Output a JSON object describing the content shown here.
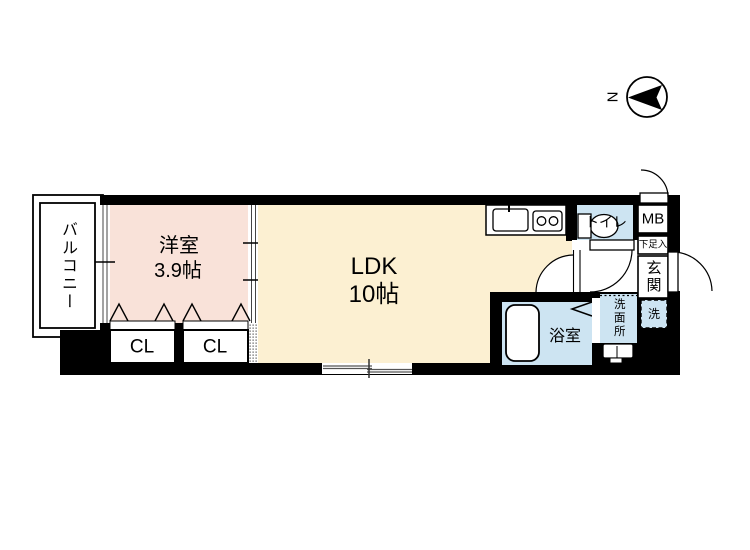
{
  "compass": {
    "north_label": "N"
  },
  "colors": {
    "wall_black": "#000000",
    "western_room_fill": "#f9e2d9",
    "ldk_fill": "#fcf0d2",
    "wet_area_fill": "#cde4f2",
    "floor_white": "#ffffff",
    "window_line_gray": "#555555"
  },
  "rooms": {
    "balcony": {
      "label": "バルコニー"
    },
    "western_room": {
      "label": "洋室",
      "size": "3.9帖"
    },
    "ldk": {
      "label": "LDK",
      "size": "10帖"
    },
    "closet_left": {
      "label": "CL"
    },
    "closet_right": {
      "label": "CL"
    },
    "toilet": {
      "label": "トイレ"
    },
    "meter_box": {
      "label": "MB"
    },
    "shoe_cabinet": {
      "label": "下足入"
    },
    "entrance": {
      "label": "玄関"
    },
    "bathroom": {
      "label": "浴室"
    },
    "washroom": {
      "label": "洗面所"
    },
    "washer_space": {
      "label": "洗"
    }
  }
}
